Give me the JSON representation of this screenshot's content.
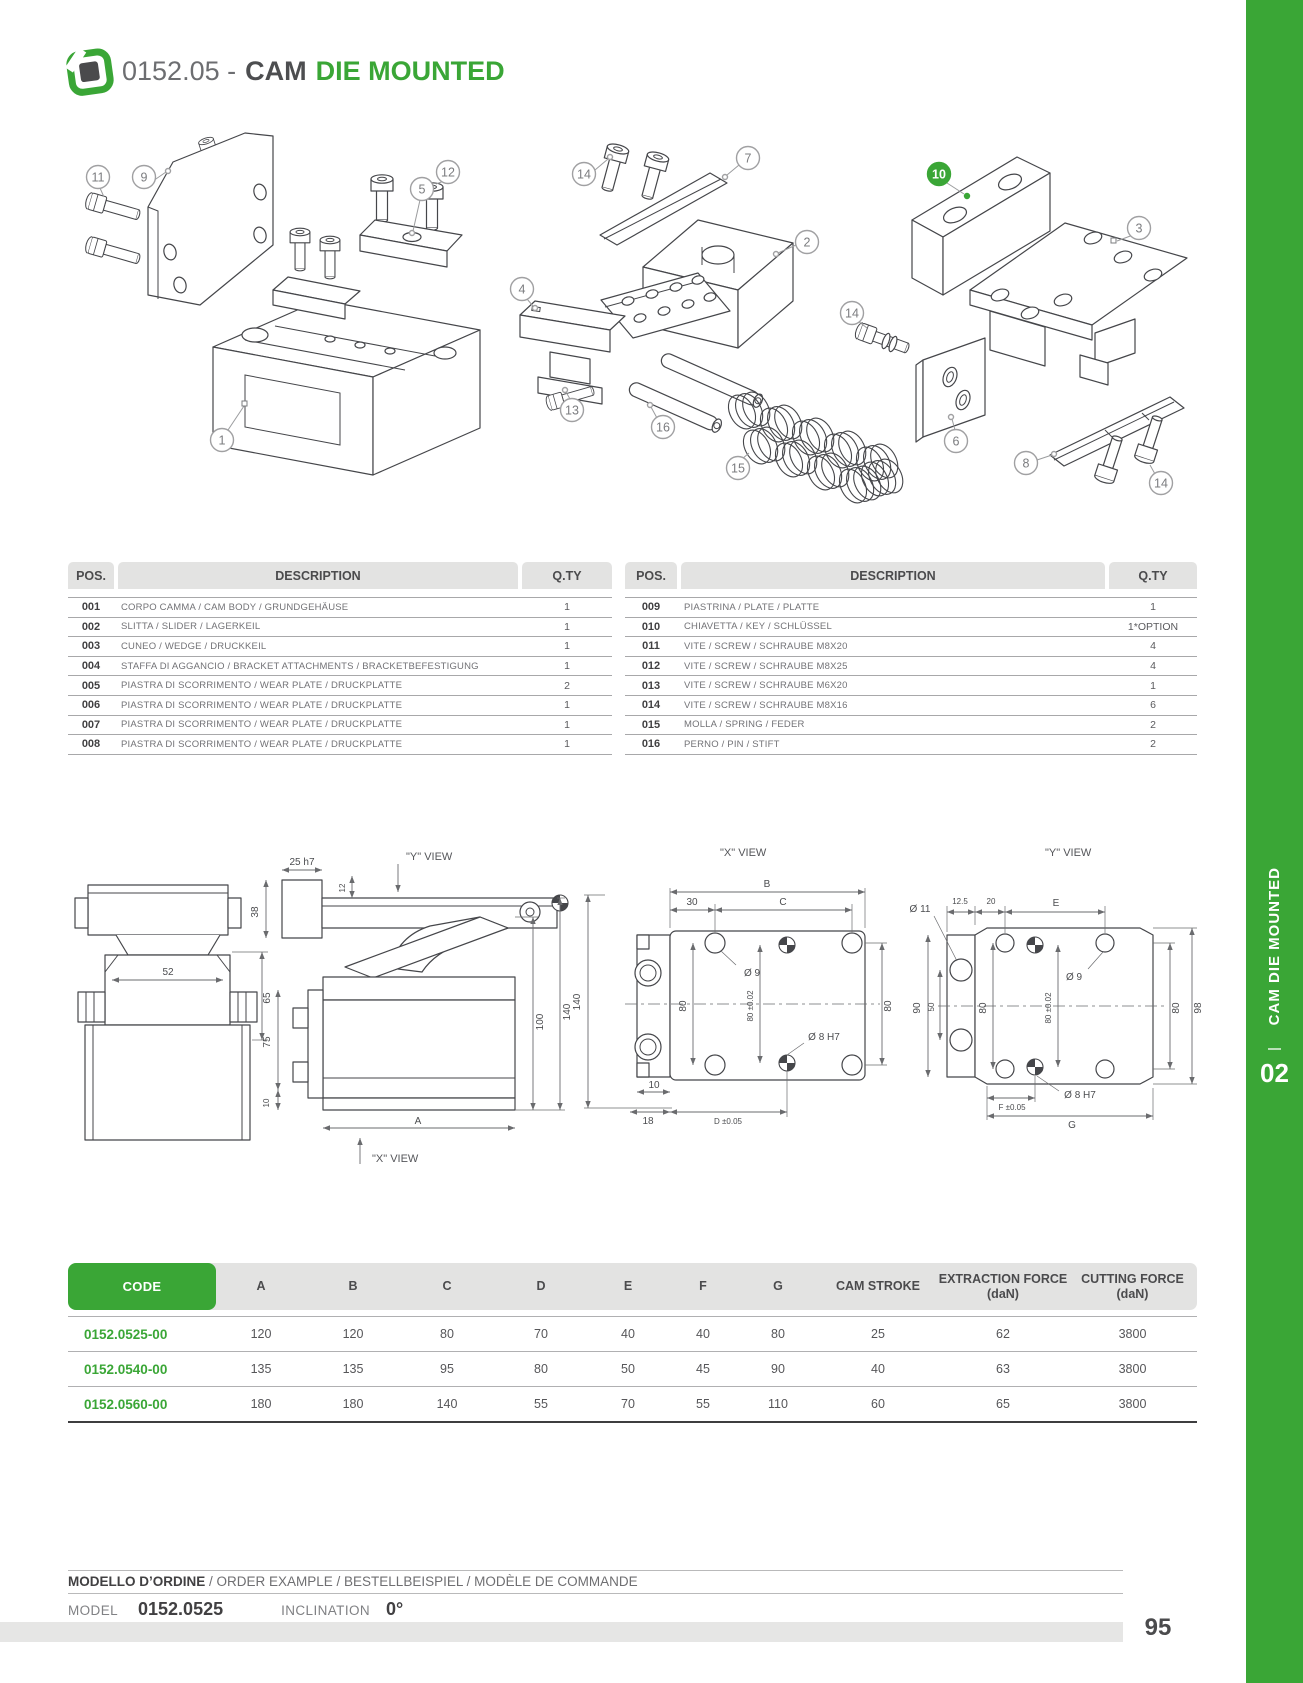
{
  "header": {
    "code": "0152.05 -",
    "title_bold": "CAM",
    "title_green": "DIE MOUNTED"
  },
  "colors": {
    "accent_green": "#3aa636",
    "dark_text": "#414042"
  },
  "parts_table": {
    "pos_header": "POS.",
    "desc_header": "DESCRIPTION",
    "qty_header": "Q.TY",
    "left_rows": [
      {
        "pos": "001",
        "desc": "CORPO CAMMA / CAM BODY / GRUNDGEHÄUSE",
        "qty": "1"
      },
      {
        "pos": "002",
        "desc": "SLITTA / SLIDER / LAGERKEIL",
        "qty": "1"
      },
      {
        "pos": "003",
        "desc": "CUNEO / WEDGE / DRUCKKEIL",
        "qty": "1"
      },
      {
        "pos": "004",
        "desc": "STAFFA DI AGGANCIO / BRACKET ATTACHMENTS / BRACKETBEFESTIGUNG",
        "qty": "1"
      },
      {
        "pos": "005",
        "desc": "PIASTRA DI SCORRIMENTO  /  WEAR PLATE /  DRUCKPLATTE",
        "qty": "2"
      },
      {
        "pos": "006",
        "desc": "PIASTRA DI SCORRIMENTO  /  WEAR PLATE /  DRUCKPLATTE",
        "qty": "1"
      },
      {
        "pos": "007",
        "desc": "PIASTRA DI SCORRIMENTO  /  WEAR PLATE /  DRUCKPLATTE",
        "qty": "1"
      },
      {
        "pos": "008",
        "desc": "PIASTRA DI SCORRIMENTO  /  WEAR PLATE /  DRUCKPLATTE",
        "qty": "1"
      }
    ],
    "right_rows": [
      {
        "pos": "009",
        "desc": "PIASTRINA / PLATE / PLATTE",
        "qty": "1"
      },
      {
        "pos": "010",
        "desc": "CHIAVETTA / KEY / SCHLÜSSEL",
        "qty": "1*OPTION"
      },
      {
        "pos": "011",
        "desc": "VITE / SCREW / SCHRAUBE M8X20",
        "qty": "4"
      },
      {
        "pos": "012",
        "desc": "VITE / SCREW / SCHRAUBE M8X25",
        "qty": "4"
      },
      {
        "pos": "013",
        "desc": "VITE / SCREW / SCHRAUBE M6X20",
        "qty": "1"
      },
      {
        "pos": "014",
        "desc": "VITE / SCREW / SCHRAUBE M8X16",
        "qty": "6"
      },
      {
        "pos": "015",
        "desc": "MOLLA / SPRING / FEDER",
        "qty": "2"
      },
      {
        "pos": "016",
        "desc": "PERNO / PIN / STIFT",
        "qty": "2"
      }
    ]
  },
  "diagram": {
    "callouts": [
      "11",
      "9",
      "12",
      "5",
      "14",
      "7",
      "2",
      "10",
      "3",
      "14",
      "4",
      "13",
      "16",
      "15",
      "6",
      "8",
      "14",
      "1"
    ]
  },
  "drawings": {
    "front_view": {
      "dim_52": "52",
      "dim_65": "65"
    },
    "side_view": {
      "y_view_label": "\"Y\" VIEW",
      "x_view_label": "\"X\" VIEW",
      "dim_25": "25  h7",
      "dim_38": "38",
      "dim_12": "12",
      "dim_75": "75",
      "dim_10": "10",
      "dim_100": "100",
      "dim_140": "140",
      "dim_a": "A"
    },
    "x_view": {
      "title": "\"X\" VIEW",
      "dim_b": "B",
      "dim_30": "30",
      "dim_c": "C",
      "dia_9": "Ø  9",
      "dim_80_left": "80",
      "dim_80_center": "80  ±0.02",
      "dim_80_right": "80",
      "dia_8": "Ø  8  H7",
      "dim_140": "140",
      "dim_10": "10",
      "dim_18": "18",
      "dim_d": "D  ±0.05"
    },
    "y_view": {
      "title": "\"Y\" VIEW",
      "dia_11": "Ø  11",
      "dim_12_5": "12.5",
      "dim_20": "20",
      "dim_e": "E",
      "dim_90": "90",
      "dim_50": "50",
      "dim_80_left": "80",
      "dim_80_center": "80  ±0.02",
      "dia_9": "Ø  9",
      "dia_8": "Ø  8  H7",
      "dim_80_right": "80",
      "dim_98": "98",
      "dim_f": "F  ±0.05",
      "dim_g": "G"
    }
  },
  "spec_table": {
    "headers": [
      {
        "l1": "CODE"
      },
      {
        "l1": "A"
      },
      {
        "l1": "B"
      },
      {
        "l1": "C"
      },
      {
        "l1": "D"
      },
      {
        "l1": "E"
      },
      {
        "l1": "F"
      },
      {
        "l1": "G"
      },
      {
        "l1": "CAM STROKE"
      },
      {
        "l1": "EXTRACTION FORCE",
        "l2": "(daN)"
      },
      {
        "l1": "CUTTING FORCE",
        "l2": "(daN)"
      }
    ],
    "rows": [
      {
        "code": "0152.0525-00",
        "values": [
          "120",
          "120",
          "80",
          "70",
          "40",
          "40",
          "80",
          "25",
          "62",
          "3800"
        ]
      },
      {
        "code": "0152.0540-00",
        "values": [
          "135",
          "135",
          "95",
          "80",
          "50",
          "45",
          "90",
          "40",
          "63",
          "3800"
        ]
      },
      {
        "code": "0152.0560-00",
        "values": [
          "180",
          "180",
          "140",
          "55",
          "70",
          "55",
          "110",
          "60",
          "65",
          "3800"
        ]
      }
    ]
  },
  "order": {
    "heading_bold": "MODELLO D’ORDINE",
    "heading_rest": " / ORDER EXAMPLE / BESTELLBEISPIEL / MODÈLE DE COMMANDE",
    "model_label": "MODEL",
    "model_value": "0152.0525",
    "inclination_label": "INCLINATION",
    "inclination_value": "0°"
  },
  "sidebar": {
    "category": "CAM DIE MOUNTED",
    "chapter": "02"
  },
  "footer": {
    "page_number": "95"
  }
}
